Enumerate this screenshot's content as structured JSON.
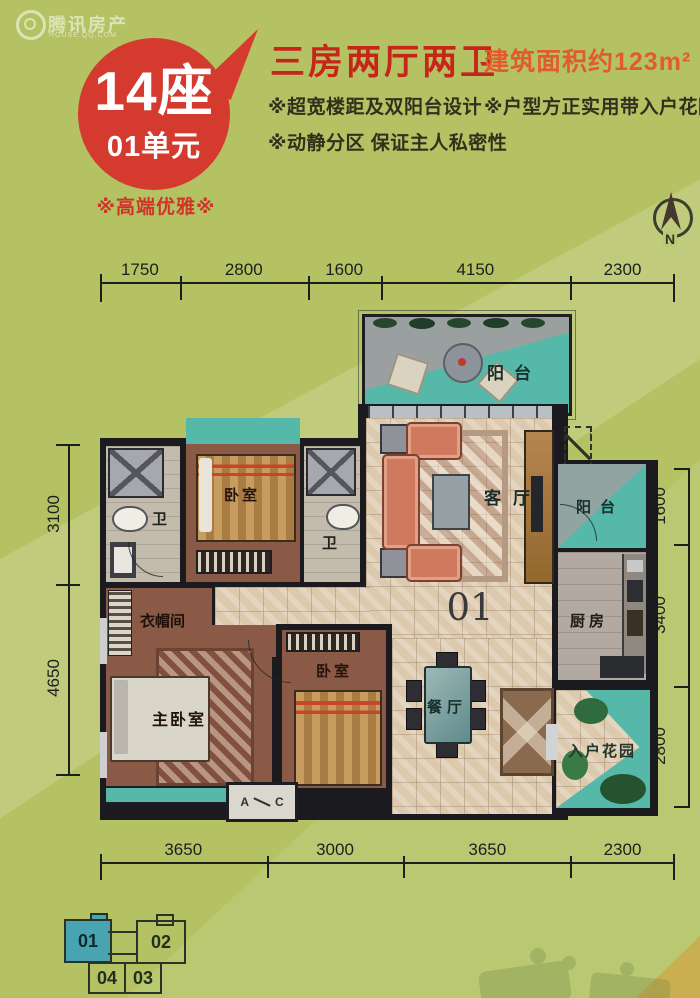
{
  "watermark": {
    "brand": "腾讯房产",
    "sub": "HOUSE.QQ.COM"
  },
  "bubble": {
    "line1": "14座",
    "line2": "01单元"
  },
  "tagline": "※高端优雅※",
  "header": {
    "title": "三房两厅两卫",
    "area": "建筑面积约123m²",
    "features": [
      "※超宽楼距及双阳台设计",
      "※户型方正实用带入户花园",
      "※动静分区 保证主人私密性"
    ]
  },
  "compass": {
    "n": "N"
  },
  "dims": {
    "top": [
      "1750",
      "2800",
      "1600",
      "4150",
      "2300"
    ],
    "bottom": [
      "3650",
      "3000",
      "3650",
      "2300"
    ],
    "left": [
      "3100",
      "4650"
    ],
    "right": [
      "1600",
      "3400",
      "2800"
    ]
  },
  "plan": {
    "unit_number": "01",
    "rooms": {
      "balcony_top": "阳台",
      "bedroom_top": "卧室",
      "bath_left": "卫",
      "bath_mid": "卫",
      "living": "客厅",
      "balcony_right": "阳台",
      "kitchen": "厨房",
      "cloakroom": "衣帽间",
      "master": "主卧室",
      "bedroom2": "卧室",
      "dining": "餐厅",
      "garden": "入户花园"
    },
    "ac_marker": {
      "a": "A",
      "c": "C"
    }
  },
  "keyplan": {
    "units": [
      {
        "label": "01",
        "active": true
      },
      {
        "label": "02",
        "active": false
      },
      {
        "label": "04",
        "active": false
      },
      {
        "label": "03",
        "active": false
      }
    ]
  },
  "colors": {
    "background": "#b4c263",
    "accent_red": "#d53a2e",
    "title_red": "#c6251a",
    "area_orange": "#e25b2d",
    "balcony_teal": "#55b8a8",
    "wall_dark": "#1b1b1f",
    "keyplan_active": "#49a4b2"
  }
}
